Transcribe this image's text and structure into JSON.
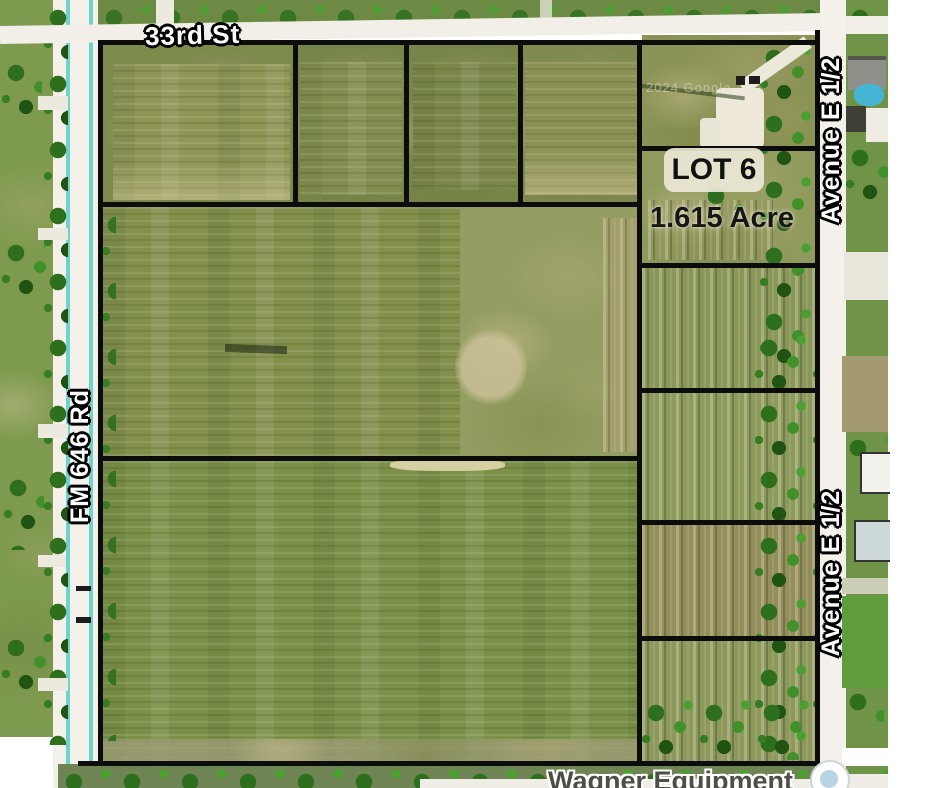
{
  "map": {
    "type": "aerial-parcel-map",
    "streets": {
      "top": "33rd St",
      "left": "FM 646 Rd",
      "right_upper": "Avenue E 1/2",
      "right_lower": "Avenue E 1/2",
      "bottom_business": "Wagner Equipment"
    },
    "lot": {
      "name": "LOT 6",
      "area": "1.615 Acre"
    },
    "watermark": "2024 Google",
    "colors": {
      "boundary_line": "#0c0c0c",
      "road_fill": "#f4f1ea",
      "road_edge_cyan": "#6fd2cc",
      "field_olive": "#87914f",
      "tree_green": "#2e6f1e",
      "lot_label_bg": "#ece8d6",
      "lot_label_text": "#111111",
      "street_label_text": "#ffffff",
      "pool_blue": "#45b5d6"
    }
  }
}
